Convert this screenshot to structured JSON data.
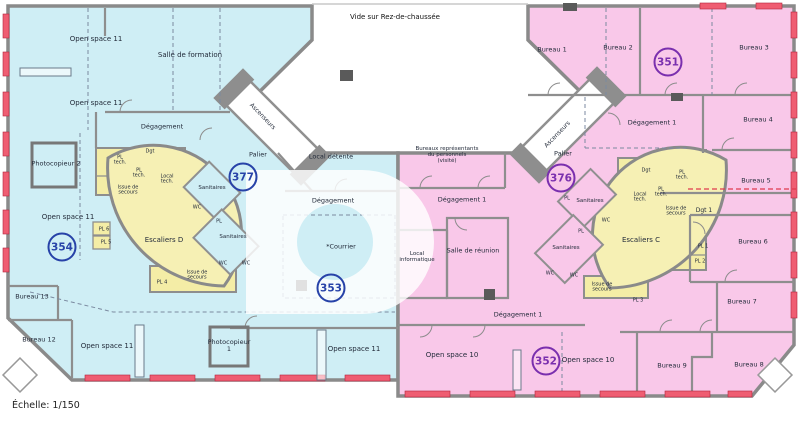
{
  "scale_label": "Échelle: 1/150",
  "colors": {
    "zone_left": "#cfeef5",
    "zone_right": "#f9c8e9",
    "stair_core": "#f4eda6",
    "stair_leaf": "#f6f0b4",
    "wall": "#8e8e8e",
    "window_mark": "#ef5d72",
    "number_blue": "#2742a8",
    "number_purple": "#7a2fae",
    "label_text": "#232b3a"
  },
  "plan": {
    "labels": [
      {
        "name": "room-open-space-11-top",
        "text": "Open space 11",
        "x": 96,
        "y": 40,
        "s": 7
      },
      {
        "name": "room-salle-de-formation",
        "text": "Salle de formation",
        "x": 190,
        "y": 56,
        "s": 7
      },
      {
        "name": "room-open-space-11-mid",
        "text": "Open space 11",
        "x": 96,
        "y": 104,
        "s": 7
      },
      {
        "name": "room-degagement-nw",
        "text": "Dégagement",
        "x": 162,
        "y": 127,
        "s": 6.5
      },
      {
        "name": "room-photocopieur-2",
        "text": "Photocopieur 2",
        "x": 56,
        "y": 164,
        "s": 6.5
      },
      {
        "name": "room-open-space-11-left",
        "text": "Open space 11",
        "x": 68,
        "y": 218,
        "s": 7
      },
      {
        "name": "room-bureau-13",
        "text": "Bureau 13",
        "x": 32,
        "y": 297,
        "s": 6.5
      },
      {
        "name": "room-bureau-12",
        "text": "Bureau 12",
        "x": 39,
        "y": 340,
        "s": 6.5
      },
      {
        "name": "room-open-space-11-bottom",
        "text": "Open space 11",
        "x": 107,
        "y": 347,
        "s": 7
      },
      {
        "name": "room-photocopieur-1",
        "text": "Photocopieur\n1",
        "x": 229,
        "y": 346,
        "s": 6.5
      },
      {
        "name": "room-open-space-11-bottom-right",
        "text": "Open space 11",
        "x": 354,
        "y": 350,
        "s": 7
      },
      {
        "name": "room-palier-d",
        "text": "Palier",
        "x": 258,
        "y": 155,
        "s": 6.5
      },
      {
        "name": "room-local-detente",
        "text": "Local détente",
        "x": 331,
        "y": 157,
        "s": 6.5
      },
      {
        "name": "room-degagement-center",
        "text": "Dégagement",
        "x": 333,
        "y": 201,
        "s": 6.5
      },
      {
        "name": "room-courrier",
        "text": "*Courrier",
        "x": 341,
        "y": 247,
        "s": 6.5
      },
      {
        "name": "room-escaliers-d",
        "text": "Escaliers D",
        "x": 164,
        "y": 241,
        "s": 7
      },
      {
        "name": "label-dgt-d",
        "text": "Dgt",
        "x": 150,
        "y": 152,
        "s": 5
      },
      {
        "name": "label-pl-tech-d-1",
        "text": "PL\ntech.",
        "x": 120,
        "y": 161,
        "s": 5
      },
      {
        "name": "label-pl-tech-d-2",
        "text": "PL\ntech.",
        "x": 139,
        "y": 174,
        "s": 5
      },
      {
        "name": "label-local-tech-d",
        "text": "Local\ntech.",
        "x": 167,
        "y": 180,
        "s": 5
      },
      {
        "name": "label-issue-secours-d-top",
        "text": "Issue de\nsecours",
        "x": 128,
        "y": 191,
        "s": 5
      },
      {
        "name": "label-pl-6",
        "text": "PL 6",
        "x": 104,
        "y": 230,
        "s": 5
      },
      {
        "name": "label-pl-5",
        "text": "PL 5",
        "x": 106,
        "y": 243,
        "s": 5
      },
      {
        "name": "label-pl-4",
        "text": "PL 4",
        "x": 162,
        "y": 283,
        "s": 5
      },
      {
        "name": "label-issue-secours-d-bottom",
        "text": "Issue de\nsecours",
        "x": 197,
        "y": 276,
        "s": 5
      },
      {
        "name": "label-sanitaires-d-1",
        "text": "Sanitaires",
        "x": 212,
        "y": 189,
        "s": 5.5
      },
      {
        "name": "label-wc-d-1",
        "text": "WC",
        "x": 197,
        "y": 208,
        "s": 5
      },
      {
        "name": "label-pl-d",
        "text": "PL",
        "x": 219,
        "y": 222,
        "s": 5
      },
      {
        "name": "label-sanitaires-d-2",
        "text": "Sanitaires",
        "x": 233,
        "y": 238,
        "s": 5.5
      },
      {
        "name": "label-wc-d-2",
        "text": "WC",
        "x": 223,
        "y": 264,
        "s": 5
      },
      {
        "name": "label-wc-d-3",
        "text": "WC",
        "x": 246,
        "y": 264,
        "s": 5
      },
      {
        "name": "label-vide-rdc",
        "text": "Vide sur Rez-de-chaussée",
        "x": 395,
        "y": 18,
        "s": 7,
        "c": "#111111"
      },
      {
        "name": "label-ascenseurs-left",
        "text": "Ascenseurs",
        "x": 262,
        "y": 117,
        "s": 6,
        "r": 46
      },
      {
        "name": "label-ascenseurs-right",
        "text": "Ascenseurs",
        "x": 558,
        "y": 135,
        "s": 6,
        "r": -46
      },
      {
        "name": "room-bureau-1",
        "text": "Bureau 1",
        "x": 552,
        "y": 50,
        "s": 6.5
      },
      {
        "name": "room-bureau-2",
        "text": "Bureau 2",
        "x": 618,
        "y": 48,
        "s": 6.5
      },
      {
        "name": "room-bureau-3",
        "text": "Bureau 3",
        "x": 754,
        "y": 48,
        "s": 6.5
      },
      {
        "name": "room-degagement-1-top",
        "text": "Dégagement 1",
        "x": 652,
        "y": 123,
        "s": 6.5
      },
      {
        "name": "room-bureau-4",
        "text": "Bureau 4",
        "x": 758,
        "y": 120,
        "s": 6.5
      },
      {
        "name": "room-bureau-5",
        "text": "Bureau 5",
        "x": 756,
        "y": 181,
        "s": 6.5
      },
      {
        "name": "label-dgt-1",
        "text": "Dgt 1",
        "x": 704,
        "y": 211,
        "s": 6
      },
      {
        "name": "room-bureau-6",
        "text": "Bureau 6",
        "x": 753,
        "y": 242,
        "s": 6.5
      },
      {
        "name": "room-bureau-7",
        "text": "Bureau 7",
        "x": 742,
        "y": 302,
        "s": 6.5
      },
      {
        "name": "room-bureau-8",
        "text": "Bureau 8",
        "x": 749,
        "y": 365,
        "s": 6.5
      },
      {
        "name": "room-bureau-9",
        "text": "Bureau 9",
        "x": 672,
        "y": 366,
        "s": 6.5
      },
      {
        "name": "room-bureaux-representants",
        "text": "Bureaux représentants\ndu personnels\n(visité)",
        "x": 447,
        "y": 156,
        "s": 5.5
      },
      {
        "name": "room-palier-c",
        "text": "Palier",
        "x": 563,
        "y": 154,
        "s": 6.5
      },
      {
        "name": "label-dgt-c",
        "text": "Dgt",
        "x": 646,
        "y": 171,
        "s": 5
      },
      {
        "name": "label-pl-tech-c-1",
        "text": "PL\ntech.",
        "x": 682,
        "y": 176,
        "s": 5
      },
      {
        "name": "label-pl-tech-c-2",
        "text": "PL\ntech.",
        "x": 661,
        "y": 193,
        "s": 5
      },
      {
        "name": "label-local-tech-c",
        "text": "Local\ntech.",
        "x": 640,
        "y": 198,
        "s": 5
      },
      {
        "name": "label-issue-secours-c-top",
        "text": "Issue de\nsecours",
        "x": 676,
        "y": 212,
        "s": 5
      },
      {
        "name": "room-escaliers-c",
        "text": "Escaliers C",
        "x": 641,
        "y": 241,
        "s": 7
      },
      {
        "name": "label-pl-1",
        "text": "PL 1",
        "x": 703,
        "y": 247,
        "s": 5
      },
      {
        "name": "label-pl-2",
        "text": "PL 2",
        "x": 700,
        "y": 262,
        "s": 5
      },
      {
        "name": "label-pl-3",
        "text": "PL 3",
        "x": 638,
        "y": 301,
        "s": 5
      },
      {
        "name": "label-issue-secours-c-bottom",
        "text": "Issue de\nsecours",
        "x": 602,
        "y": 288,
        "s": 5
      },
      {
        "name": "label-sanitaires-c-1",
        "text": "Sanitaires",
        "x": 590,
        "y": 202,
        "s": 5.5
      },
      {
        "name": "label-pl-c-1",
        "text": "PL",
        "x": 567,
        "y": 199,
        "s": 5
      },
      {
        "name": "label-wc-c-1",
        "text": "WC",
        "x": 606,
        "y": 221,
        "s": 5
      },
      {
        "name": "label-pl-c-2",
        "text": "PL",
        "x": 581,
        "y": 232,
        "s": 5
      },
      {
        "name": "label-sanitaires-c-2",
        "text": "Sanitaires",
        "x": 566,
        "y": 249,
        "s": 5.5
      },
      {
        "name": "label-wc-c-2",
        "text": "WC",
        "x": 550,
        "y": 274,
        "s": 5
      },
      {
        "name": "label-wc-c-3",
        "text": "WC",
        "x": 574,
        "y": 276,
        "s": 5
      },
      {
        "name": "room-local-informatique",
        "text": "Local\ninformatique",
        "x": 417,
        "y": 258,
        "s": 5.5
      },
      {
        "name": "room-degagement-1-mid",
        "text": "Dégagement 1",
        "x": 462,
        "y": 200,
        "s": 6.5
      },
      {
        "name": "room-salle-de-reunion",
        "text": "Salle de réunion",
        "x": 473,
        "y": 251,
        "s": 6.5
      },
      {
        "name": "room-degagement-1-bottom",
        "text": "Dégagement 1",
        "x": 518,
        "y": 315,
        "s": 6.5
      },
      {
        "name": "room-open-space-10-left",
        "text": "Open space 10",
        "x": 452,
        "y": 356,
        "s": 7
      },
      {
        "name": "room-open-space-10-right",
        "text": "Open space 10",
        "x": 588,
        "y": 361,
        "s": 7
      }
    ],
    "room_numbers": [
      {
        "name": "room-number-354",
        "text": "354",
        "x": 62,
        "y": 247,
        "c": "blue"
      },
      {
        "name": "room-number-377",
        "text": "377",
        "x": 243,
        "y": 177,
        "c": "blue"
      },
      {
        "name": "room-number-353",
        "text": "353",
        "x": 331,
        "y": 288,
        "c": "blue"
      },
      {
        "name": "room-number-351",
        "text": "351",
        "x": 668,
        "y": 62,
        "c": "purple"
      },
      {
        "name": "room-number-376",
        "text": "376",
        "x": 561,
        "y": 178,
        "c": "purple"
      },
      {
        "name": "room-number-352",
        "text": "352",
        "x": 546,
        "y": 361,
        "c": "purple"
      }
    ]
  }
}
